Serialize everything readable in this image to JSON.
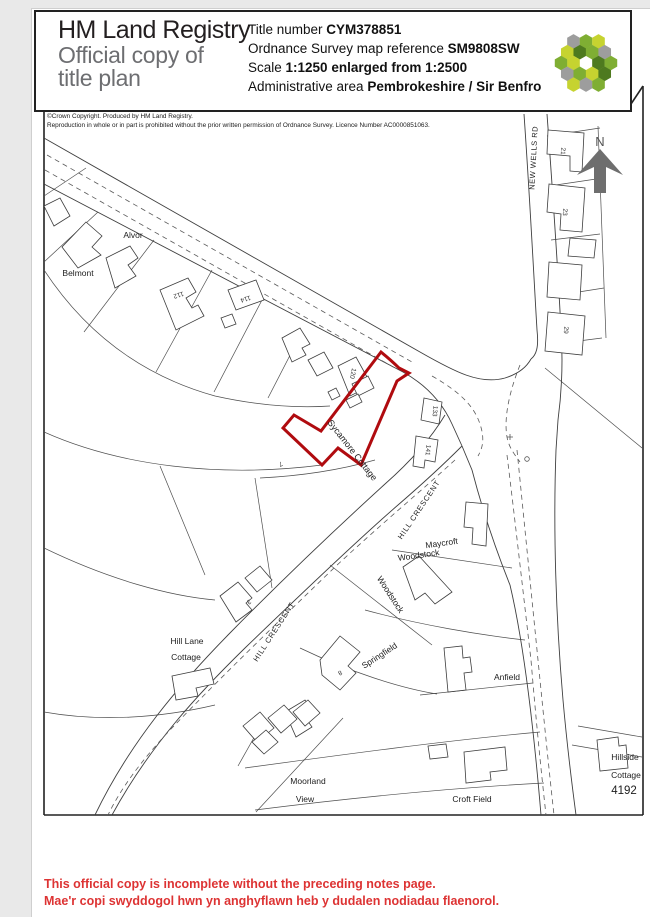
{
  "header": {
    "brand_line1": "HM Land Registry",
    "brand_line2": "Official copy of",
    "brand_line3": "title plan",
    "title_number_label": "Title number ",
    "title_number": "CYM378851",
    "os_ref_label": "Ordnance Survey map reference ",
    "os_ref": "SM9808SW",
    "scale_label": "Scale ",
    "scale": "1:1250 enlarged from 1:2500",
    "admin_area_label": "Administrative area ",
    "admin_area": "Pembrokeshire / Sir Benfro"
  },
  "logo": {
    "palette": {
      "lime": "#c6d330",
      "green": "#7fae33",
      "dark": "#4e7a1f",
      "gray": "#9d9d9d"
    },
    "cells": [
      {
        "x": -12.5,
        "y": -21.6,
        "c": "gray"
      },
      {
        "x": 0,
        "y": -21.6,
        "c": "green"
      },
      {
        "x": 12.5,
        "y": -21.6,
        "c": "lime"
      },
      {
        "x": -18.7,
        "y": -10.8,
        "c": "lime"
      },
      {
        "x": -6.2,
        "y": -10.8,
        "c": "dark"
      },
      {
        "x": 6.2,
        "y": -10.8,
        "c": "green"
      },
      {
        "x": 18.7,
        "y": -10.8,
        "c": "gray"
      },
      {
        "x": -24.9,
        "y": 0,
        "c": "green"
      },
      {
        "x": -12.5,
        "y": 0,
        "c": "lime"
      },
      {
        "x": 12.5,
        "y": 0,
        "c": "dark"
      },
      {
        "x": 24.9,
        "y": 0,
        "c": "green"
      },
      {
        "x": -18.7,
        "y": 10.8,
        "c": "gray"
      },
      {
        "x": -6.2,
        "y": 10.8,
        "c": "green"
      },
      {
        "x": 6.2,
        "y": 10.8,
        "c": "lime"
      },
      {
        "x": 18.7,
        "y": 10.8,
        "c": "dark"
      },
      {
        "x": -12.5,
        "y": 21.6,
        "c": "lime"
      },
      {
        "x": 0,
        "y": 21.6,
        "c": "gray"
      },
      {
        "x": 12.5,
        "y": 21.6,
        "c": "green"
      }
    ]
  },
  "copyright": {
    "line1": "©Crown Copyright.  Produced by HM Land Registry.",
    "line2": "Reproduction in whole or in part is prohibited without the prior written permission of Ordnance Survey. Licence Number AC0000851063."
  },
  "map": {
    "north_label": "N",
    "parcel_color": "#b00b0f",
    "labels": [
      {
        "text": "Alvor"
      },
      {
        "text": "Belmont"
      },
      {
        "text": "Sycamore Cottage"
      },
      {
        "text": "NEW WELLS RD"
      },
      {
        "text": "HILL CRESCENT"
      },
      {
        "text": "HILL CRESCENT"
      },
      {
        "text": "Maycroft"
      },
      {
        "text": "Woodstock"
      },
      {
        "text": "Woodstock"
      },
      {
        "text": "Springfield"
      },
      {
        "text": "Hill Lane"
      },
      {
        "text": "Cottage"
      },
      {
        "text": "Anfield"
      },
      {
        "text": "Moorland"
      },
      {
        "text": "View"
      },
      {
        "text": "Croft Field"
      },
      {
        "text": "Hillside"
      },
      {
        "text": "Cottage"
      },
      {
        "text": "4192"
      }
    ],
    "house_numbers": [
      {
        "text": "112"
      },
      {
        "text": "114"
      },
      {
        "text": "120"
      },
      {
        "text": "133"
      },
      {
        "text": "141"
      },
      {
        "text": "21"
      },
      {
        "text": "23"
      },
      {
        "text": "29"
      },
      {
        "text": "8"
      },
      {
        "text": "7"
      },
      {
        "text": "3"
      }
    ]
  },
  "footer": {
    "color": "#dd3333",
    "line1_en": "This official copy is incomplete without the preceding notes page.",
    "line2_cy": "Mae'r copi swyddogol hwn yn anghyflawn heb y dudalen nodiadau flaenorol."
  }
}
